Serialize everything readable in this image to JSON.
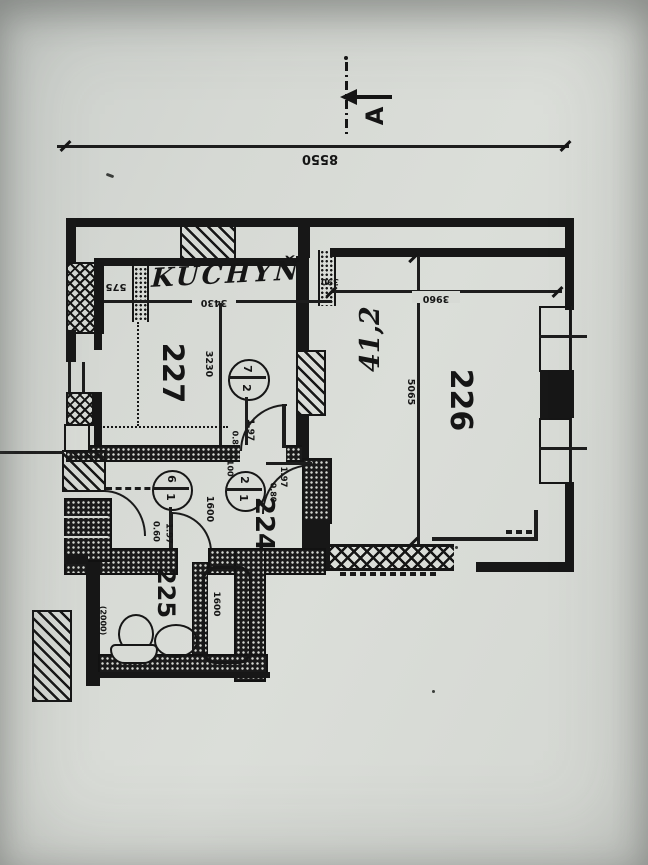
{
  "photo": {
    "paper_color": "#d6d9d4",
    "ink_color": "#161616"
  },
  "section_marker": {
    "label": "A"
  },
  "overall_dimension": {
    "value": "8550"
  },
  "rooms": {
    "kitchen": {
      "name": "KUCHYŇ",
      "number": "227",
      "width_dim": "3430",
      "strip_dim": "575",
      "depth_dim": "3230"
    },
    "living_room": {
      "number": "226",
      "width_dim": "3960",
      "depth_dim": "5065",
      "wall_dim": "390",
      "handwritten_area": "41,2"
    },
    "hall": {
      "number": "224",
      "width_dim": "1600",
      "opening_dim": "1100"
    },
    "bathroom": {
      "number": "225",
      "length_dim": "(2000)",
      "bathtub_dim": "1600"
    }
  },
  "door_marks": {
    "mark_7_2": {
      "top": "7",
      "bottom": "2"
    },
    "mark_6_1": {
      "top": "6",
      "bottom": "1"
    },
    "mark_2_1": {
      "top": "2",
      "bottom": "1"
    }
  },
  "door_labels": {
    "door_227": {
      "width": "0.80",
      "height": "1.97"
    },
    "door_226": {
      "width": "0.80",
      "height": "1.97"
    },
    "door_bathroom": {
      "width": "0.60",
      "height": "1.97"
    }
  }
}
